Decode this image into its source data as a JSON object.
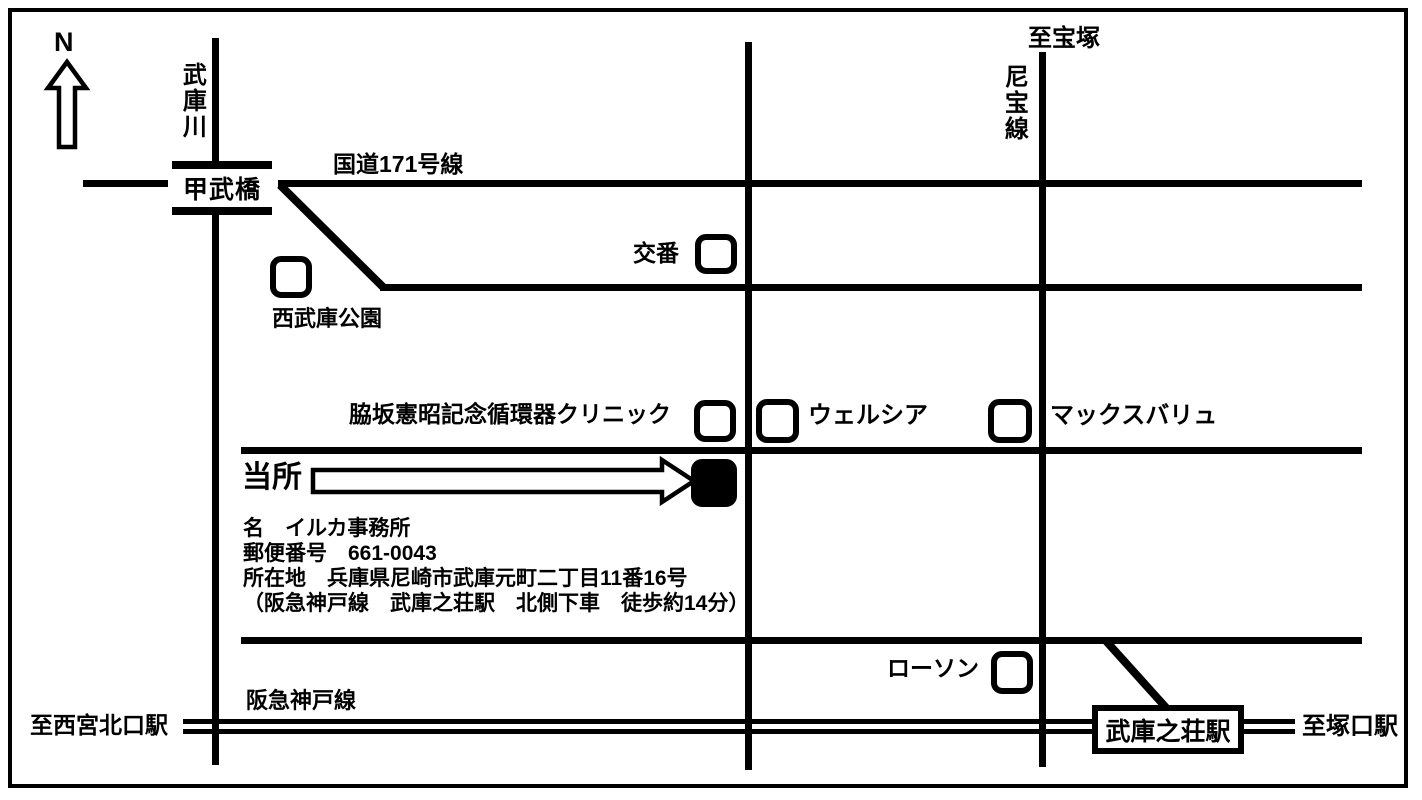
{
  "map": {
    "compass": {
      "north_label": "N"
    },
    "labels": {
      "mukogawa_river": "武庫川",
      "kobu_bridge": "甲武橋",
      "route_171": "国道171号線",
      "to_takarazuka": "至宝塚",
      "niho_line": "尼宝線",
      "police_box": "交番",
      "nishimuko_park": "西武庫公園",
      "clinic": "脇坂憲昭記念循環器クリニック",
      "welcia": "ウェルシア",
      "max_valu": "マックスバリュ",
      "this_office": "当所",
      "lawson": "ローソン",
      "hankyu_kobe_line": "阪急神戸線",
      "to_nishinomiya_kitaguchi_sta": "至西宮北口駅",
      "mukonoso_station": "武庫之荘駅",
      "to_tsukaguchi_sta": "至塚口駅"
    },
    "office_info": {
      "line1": "名　イルカ事務所",
      "line2": "郵便番号　661-0043",
      "line3": "所在地　兵庫県尼崎市武庫元町二丁目11番16号",
      "line4": "（阪急神戸線　武庫之荘駅　北側下車　徒歩約14分）"
    },
    "colors": {
      "line": "#000000",
      "background": "#ffffff"
    }
  }
}
